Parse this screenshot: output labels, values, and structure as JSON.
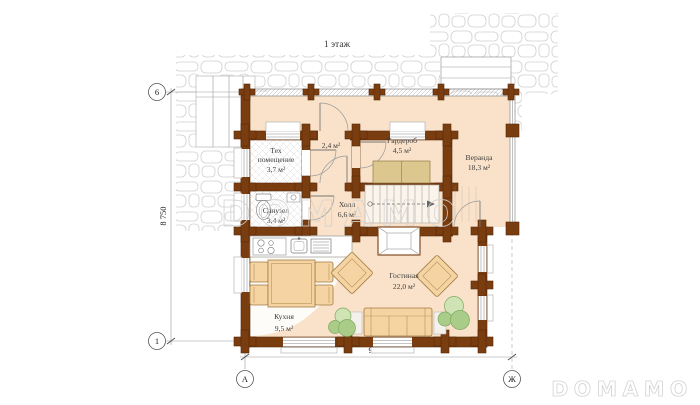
{
  "title": "1 этаж",
  "axes": {
    "top_left": "6",
    "bottom_left": "1",
    "col_a": "А",
    "col_zh": "Ж"
  },
  "dimensions": {
    "horizontal": "9 400",
    "vertical": "8 750"
  },
  "watermarks": {
    "center": "DOMAMO",
    "corner": "DOMAMO"
  },
  "rooms": [
    {
      "id": "tech",
      "name": "Тех",
      "name2": "помещение",
      "area": "3,7 м²"
    },
    {
      "id": "entry",
      "area": "2,4 м²"
    },
    {
      "id": "wardrobe",
      "name": "Гардероб",
      "area": "4,5 м²"
    },
    {
      "id": "veranda",
      "name": "Веранда",
      "area": "18,3 м²"
    },
    {
      "id": "bathroom",
      "name": "Санузел",
      "area": "3,4 м²"
    },
    {
      "id": "hall",
      "name": "Холл",
      "area": "6,6 м²"
    },
    {
      "id": "kitchen",
      "name": "Кухня",
      "area": "9,5 м²"
    },
    {
      "id": "living",
      "name": "Гостиная",
      "area": "22,0 м²"
    }
  ],
  "colors": {
    "wall": "#7a3d10",
    "wall_outline": "#572a09",
    "floor_peach": "#f9e2c9",
    "furniture_tan": "#f5d3a3",
    "closet_tan": "#dcc88f",
    "plant_green": "#a9cd88",
    "plant_light": "#cfe3b4",
    "stone_line": "#d0d0d0",
    "watermark": "#d2d2d2"
  }
}
